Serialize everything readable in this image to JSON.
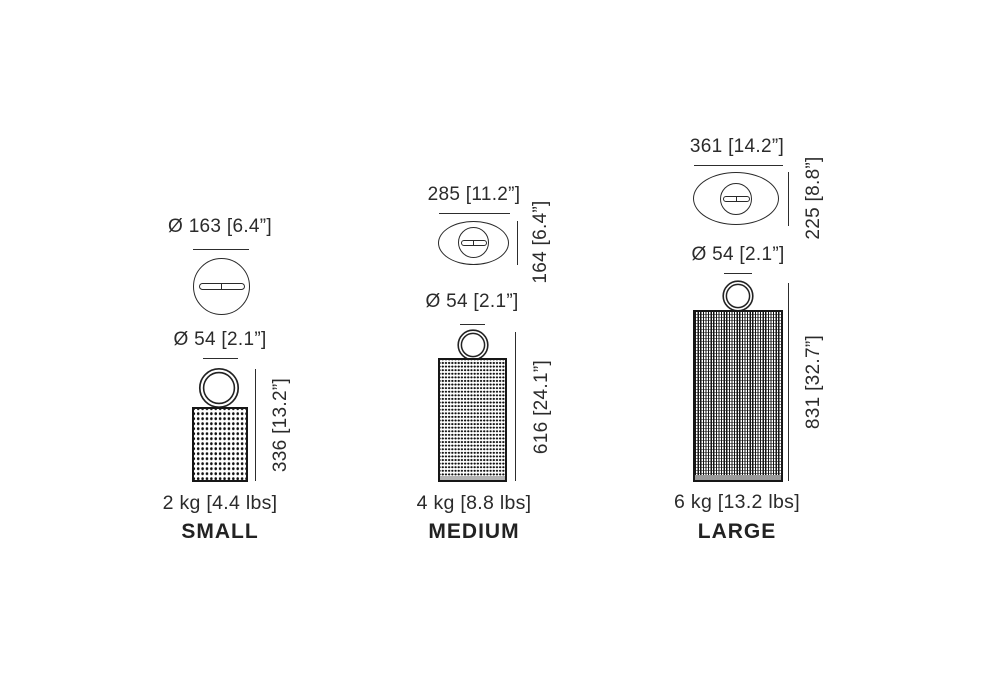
{
  "diagram": {
    "background": "#ffffff",
    "line_color": "#2d2d2d",
    "text_color": "#2b2b2b"
  },
  "variants": [
    {
      "name": "SMALL",
      "weight_label": "2 kg [4.4 lbs]",
      "top_diameter_label": "Ø 163 [6.4”]",
      "handle_diameter_label": "Ø 54 [2.1”]",
      "body_height_label": "336 [13.2”]"
    },
    {
      "name": "MEDIUM",
      "weight_label": "4 kg [8.8 lbs]",
      "top_width_label": "285 [11.2”]",
      "top_depth_label": "164 [6.4”]",
      "handle_diameter_label": "Ø 54 [2.1”]",
      "body_height_label": "616 [24.1”]"
    },
    {
      "name": "LARGE",
      "weight_label": "6 kg [13.2 lbs]",
      "top_width_label": "361 [14.2”]",
      "top_depth_label": "225 [8.8”]",
      "handle_diameter_label": "Ø 54 [2.1”]",
      "body_height_label": "831 [32.7”]"
    }
  ]
}
